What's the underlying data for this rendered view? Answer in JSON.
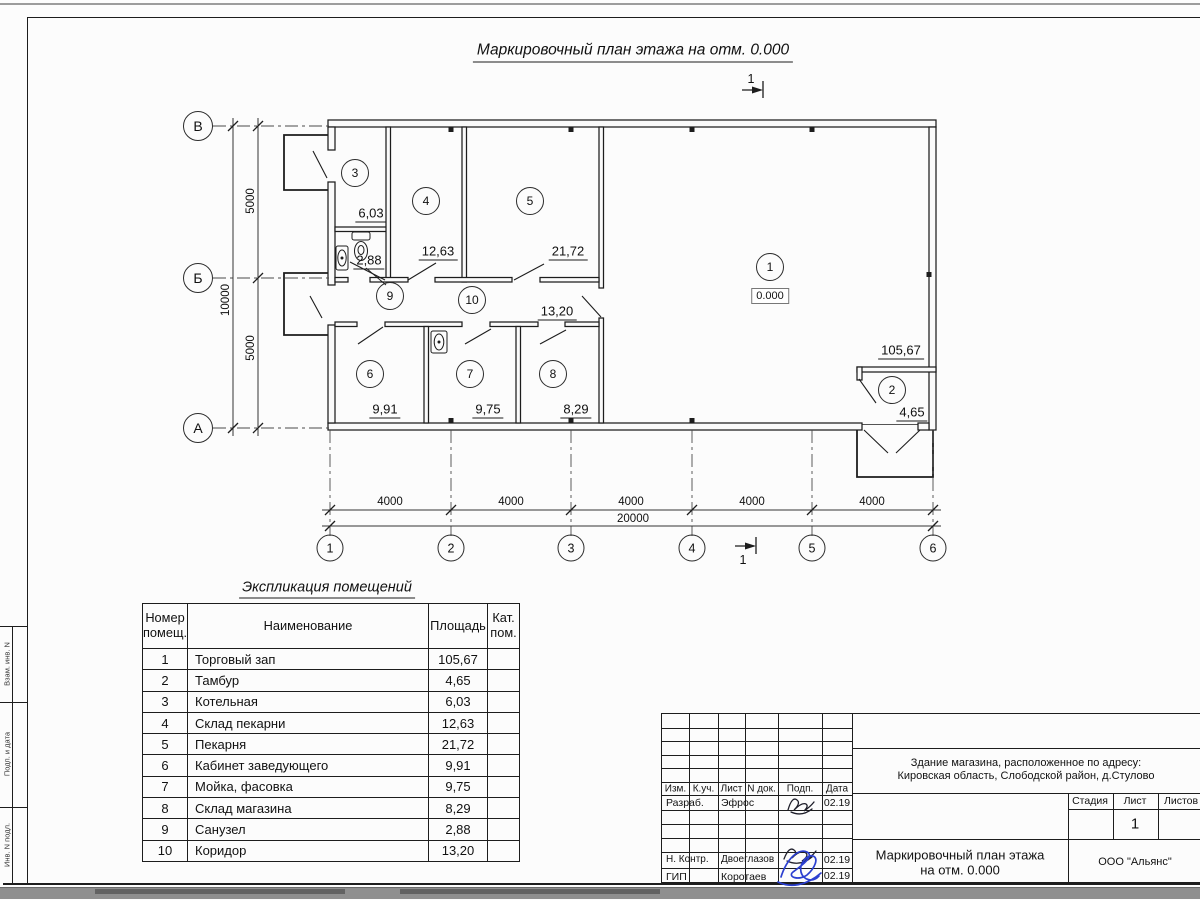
{
  "sheet": {
    "title": "Маркировочный план этажа на отм. 0.000",
    "section_mark": "1",
    "margin_labels": [
      "Взам. инв. N",
      "Подп. и дата",
      "Инв. N подл."
    ]
  },
  "plan": {
    "row_axes": [
      "В",
      "Б",
      "А"
    ],
    "col_axes": [
      "1",
      "2",
      "3",
      "4",
      "5",
      "6"
    ],
    "dims": {
      "span_v": "5000",
      "total_v": "10000",
      "bay": "4000",
      "total_h": "20000"
    },
    "elevation": "0.000",
    "rooms": [
      {
        "number": "1",
        "area": "105,67"
      },
      {
        "number": "2",
        "area": "4,65"
      },
      {
        "number": "3",
        "area": "6,03"
      },
      {
        "number": "4",
        "area": "12,63"
      },
      {
        "number": "5",
        "area": "21,72"
      },
      {
        "number": "6",
        "area": "9,91"
      },
      {
        "number": "7",
        "area": "9,75"
      },
      {
        "number": "8",
        "area": "8,29"
      },
      {
        "number": "9",
        "area": "2,88"
      },
      {
        "number": "10",
        "area": "13,20"
      }
    ]
  },
  "explication": {
    "title": "Экспликация помещений",
    "headers": {
      "number": "Номер помещ.",
      "name": "Наименование",
      "area": "Площадь",
      "category": "Кат. пом."
    },
    "rows": [
      {
        "num": "1",
        "name": "Торговый зап",
        "area": "105,67"
      },
      {
        "num": "2",
        "name": "Тамбур",
        "area": "4,65"
      },
      {
        "num": "3",
        "name": "Котельная",
        "area": "6,03"
      },
      {
        "num": "4",
        "name": "Склад пекарни",
        "area": "12,63"
      },
      {
        "num": "5",
        "name": "Пекарня",
        "area": "21,72"
      },
      {
        "num": "6",
        "name": "Кабинет заведующего",
        "area": "9,91"
      },
      {
        "num": "7",
        "name": "Мойка, фасовка",
        "area": "9,75"
      },
      {
        "num": "8",
        "name": "Склад магазина",
        "area": "8,29"
      },
      {
        "num": "9",
        "name": "Санузел",
        "area": "2,88"
      },
      {
        "num": "10",
        "name": "Коридор",
        "area": "13,20"
      }
    ]
  },
  "stamp": {
    "object_address_line1": "Здание магазина, расположенное по адресу:",
    "object_address_line2": "Кировская область, Слободской район, д.Стулово",
    "header_cols": [
      "Изм.",
      "К.уч.",
      "Лист",
      "N док.",
      "Подп.",
      "Дата"
    ],
    "signature_rows": [
      {
        "role": "Разраб.",
        "name": "Эфрос",
        "date": "02.19"
      },
      {
        "role": "Н. Контр.",
        "name": "Двоеглазов",
        "date": "02.19"
      },
      {
        "role": "ГИП",
        "name": "Коротаев",
        "date": "02.19"
      }
    ],
    "stage_label": "Стадия",
    "sheet_label": "Лист",
    "sheets_label": "Листов",
    "sheet_number": "1",
    "doc_title_line1": "Маркировочный план этажа",
    "doc_title_line2": "на отм. 0.000",
    "company": "ООО \"Альянс\""
  }
}
